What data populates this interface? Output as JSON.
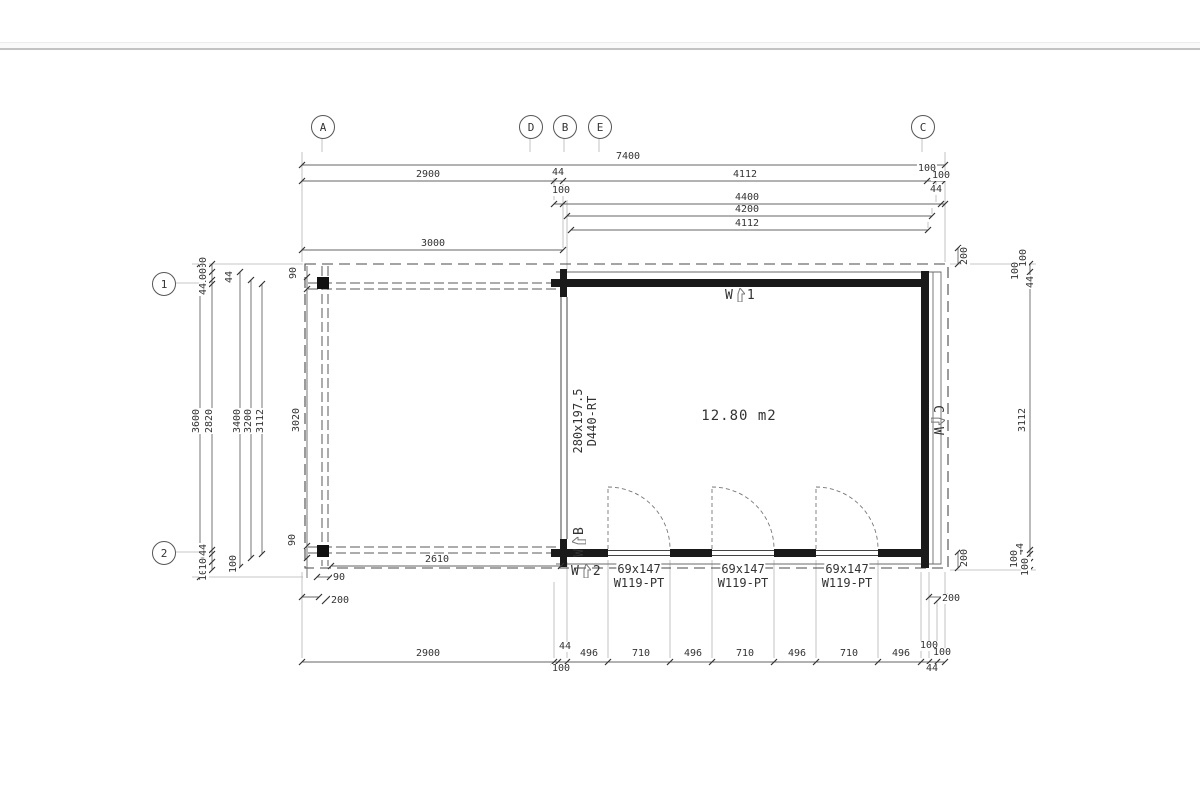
{
  "grid": {
    "columns": [
      "A",
      "D",
      "B",
      "E",
      "C"
    ],
    "rows": [
      "1",
      "2"
    ]
  },
  "room": {
    "area": "12.80 m2"
  },
  "views": {
    "prefix": "W",
    "v1": "1",
    "v2": "2",
    "vb": "B",
    "vc": "C"
  },
  "door": {
    "size": "280x197.5",
    "code": "D440-RT"
  },
  "window": {
    "size": "69x147",
    "code": "W119-PT"
  },
  "dims": {
    "total_width": "7400",
    "row2": {
      "a": "2900",
      "b": "44",
      "c": "4112",
      "d": "100",
      "e": "100"
    },
    "row3": {
      "a": "100",
      "b": "4400",
      "c": "44"
    },
    "row4": "4200",
    "row5": "4112",
    "terrace_width": "3000",
    "terrace_bottom": "2610",
    "post": "90",
    "overhang": "200",
    "bottom": {
      "a": "2900",
      "b": "44",
      "b2": "100",
      "c": "496",
      "d": "710",
      "e": "496",
      "f": "710",
      "g": "496",
      "h": "710",
      "i": "496",
      "j": "100",
      "k": "100",
      "l": "44"
    },
    "left": {
      "total": "3600",
      "l2820": "2820",
      "l3400": "3400",
      "l3200": "3200",
      "l3112": "3112",
      "beam": "3020",
      "mid_top": "44",
      "mid_bottom": "100",
      "stack_top": {
        "a": "100",
        "b": "100",
        "c": "44"
      },
      "stack_bottom": {
        "a": "100",
        "b": "100",
        "c": "44"
      }
    },
    "right": {
      "l3112": "3112",
      "stack_top": {
        "a": "100",
        "b": "100",
        "c": "44"
      },
      "stack_bottom": {
        "a": "44",
        "b": "100",
        "c": "100"
      }
    }
  }
}
